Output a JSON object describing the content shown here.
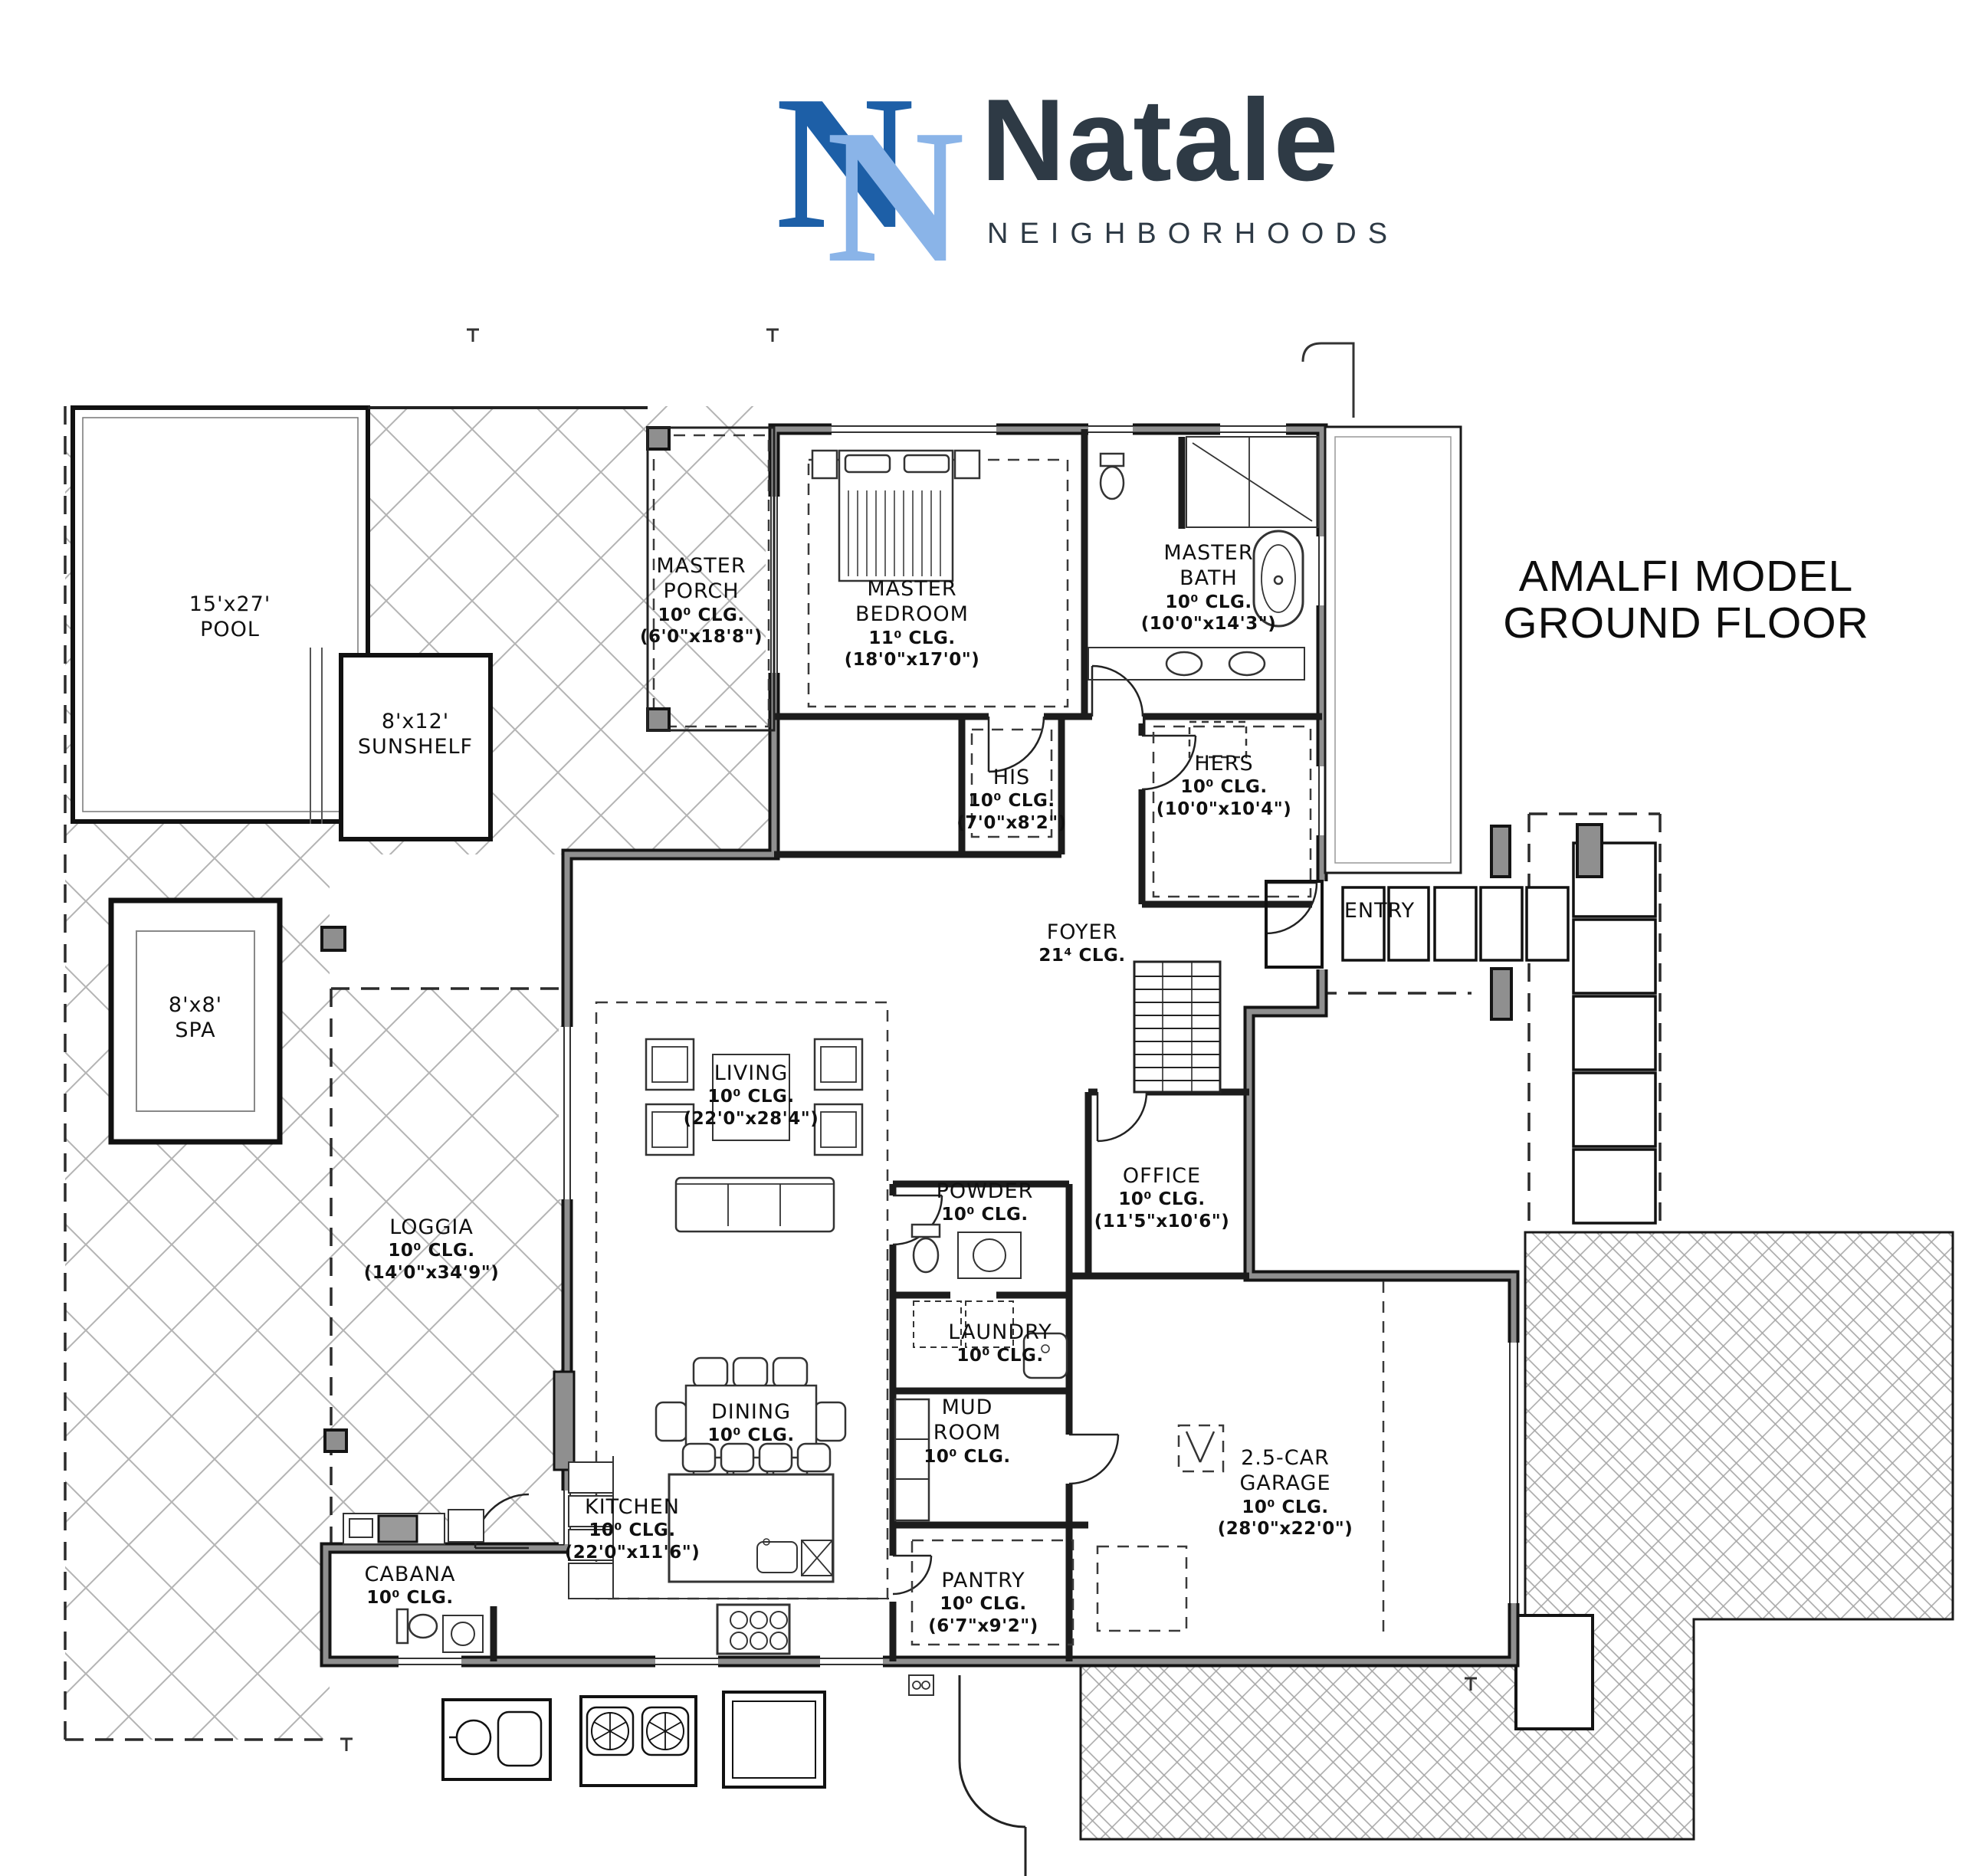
{
  "header": {
    "brand": "Natale",
    "brand_sub": "NEIGHBORHOODS",
    "monogram": "N"
  },
  "title": {
    "line1": "AMALFI MODEL",
    "line2": "GROUND FLOOR"
  },
  "rooms": {
    "pool": {
      "lines": [
        "15'x27'",
        "POOL"
      ]
    },
    "sunshelf": {
      "lines": [
        "8'x12'",
        "SUNSHELF"
      ]
    },
    "spa": {
      "lines": [
        "8'x8'",
        "SPA"
      ]
    },
    "master_porch": {
      "lines": [
        "MASTER",
        "PORCH",
        "10⁰ CLG.",
        "(6'0\"x18'8\")"
      ]
    },
    "master_bedroom": {
      "lines": [
        "MASTER",
        "BEDROOM",
        "11⁰ CLG.",
        "(18'0\"x17'0\")"
      ]
    },
    "master_bath": {
      "lines": [
        "MASTER",
        "BATH",
        "10⁰ CLG.",
        "(10'0\"x14'3\")"
      ]
    },
    "his": {
      "lines": [
        "HIS",
        "10⁰ CLG.",
        "(7'0\"x8'2\")"
      ]
    },
    "hers": {
      "lines": [
        "HERS",
        "10⁰ CLG.",
        "(10'0\"x10'4\")"
      ]
    },
    "foyer": {
      "lines": [
        "FOYER",
        "21⁴ CLG."
      ]
    },
    "entry": {
      "lines": [
        "ENTRY"
      ]
    },
    "living": {
      "lines": [
        "LIVING",
        "10⁰ CLG.",
        "(22'0\"x28'4\")"
      ]
    },
    "office": {
      "lines": [
        "OFFICE",
        "10⁰ CLG.",
        "(11'5\"x10'6\")"
      ]
    },
    "powder": {
      "lines": [
        "POWDER",
        "10⁰ CLG."
      ]
    },
    "loggia": {
      "lines": [
        "LOGGIA",
        "10⁰ CLG.",
        "(14'0\"x34'9\")"
      ]
    },
    "dining": {
      "lines": [
        "DINING",
        "10⁰ CLG."
      ]
    },
    "laundry": {
      "lines": [
        "LAUNDRY",
        "10⁰ CLG."
      ]
    },
    "mud_room": {
      "lines": [
        "MUD",
        "ROOM",
        "10⁰ CLG."
      ]
    },
    "kitchen": {
      "lines": [
        "KITCHEN",
        "10⁰ CLG.",
        "(22'0\"x11'6\")"
      ]
    },
    "pantry": {
      "lines": [
        "PANTRY",
        "10⁰ CLG.",
        "(6'7\"x9'2\")"
      ]
    },
    "cabana": {
      "lines": [
        "CABANA",
        "10⁰ CLG."
      ]
    },
    "garage": {
      "lines": [
        "2.5-CAR",
        "GARAGE",
        "10⁰ CLG.",
        "(28'0\"x22'0\")"
      ]
    }
  },
  "colors": {
    "logo_dark_blue": "#1d5fa7",
    "logo_light_blue": "#8ab4e8",
    "logo_text": "#2e3a45",
    "ink": "#111111",
    "wall_gray": "#8f8f8f"
  }
}
